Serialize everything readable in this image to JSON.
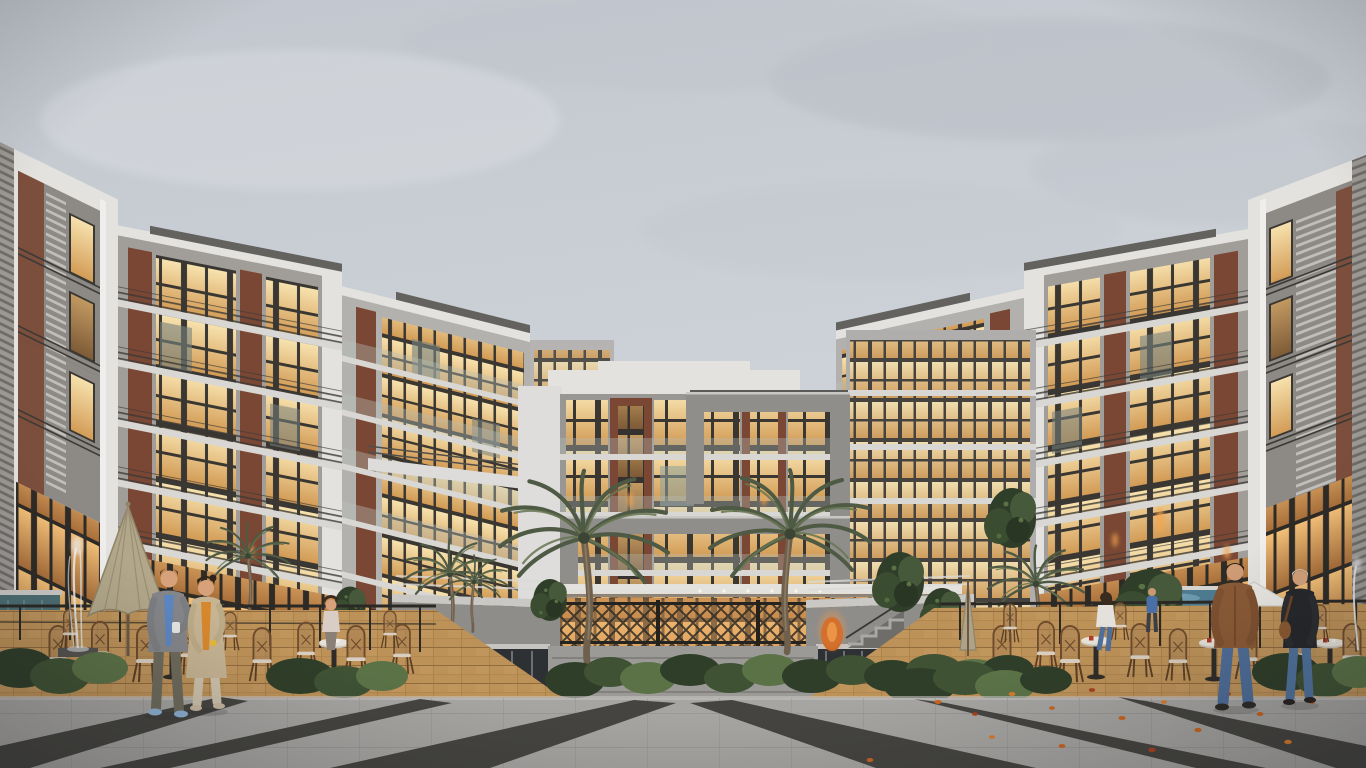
{
  "scene": {
    "type": "architectural-exterior-rendering",
    "description": "Dusk view of a modern U-shaped residential complex around a landscaped courtyard: gray concrete, white plaster and brick facades with warm glowing windows, two tall palm trees before the central block, cafe terraces with rattan bistro chairs and umbrellas on terracotta pavers, water features, and people strolling across a striped stone plaza with scattered autumn leaves.",
    "setting": {
      "sky": "overcast gray",
      "lighting": "warm interior glow at dusk",
      "ground": "light stone plaza with dark granite stripes"
    },
    "buildings": {
      "left_wing": {
        "floors": 5,
        "materials": [
          "white plaster",
          "gray concrete",
          "brick",
          "glass"
        ]
      },
      "central_block": {
        "floors": 5,
        "feature": "projecting gray frame over warm glass facade, brick piers"
      },
      "right_wing": {
        "floors": 5,
        "materials": [
          "white plaster",
          "gray concrete",
          "brick",
          "glass"
        ]
      }
    },
    "vegetation": [
      "large-palm-left",
      "large-palm-right",
      "small-palms",
      "evergreen-shrub-trees",
      "hedge-planters",
      "tropical-plant-left-terrace"
    ],
    "water_features": [
      "left-fountain-jet",
      "right-fountain-jet",
      "dark-reflecting-waterfall-walls",
      "right-blue-pool",
      "left-teal-pool"
    ],
    "cafes": {
      "left_terrace": {
        "umbrella": "tan",
        "chairs": "rattan bistro",
        "floor": "terracotta pavers"
      },
      "right_terrace": {
        "umbrella": "white",
        "chairs": "rattan bistro",
        "floor": "terracotta pavers"
      }
    },
    "people": [
      {
        "id": "walking-man-left",
        "clothing": [
          "gray blazer",
          "blue shirt",
          "olive trousers",
          "light-blue sneakers"
        ],
        "action": "walking with coffee cup"
      },
      {
        "id": "walking-woman-left",
        "clothing": [
          "long tan coat",
          "orange top",
          "beige trousers"
        ],
        "action": "walking beside man"
      },
      {
        "id": "seated-woman-left-cafe",
        "clothing": [
          "light top"
        ],
        "action": "sitting at cafe table"
      },
      {
        "id": "walking-man-right",
        "clothing": [
          "brown leather jacket",
          "blue jeans"
        ],
        "action": "walking away from viewer"
      },
      {
        "id": "walking-woman-right",
        "clothing": [
          "black jacket",
          "blue jeans",
          "brown shoulder bag"
        ],
        "action": "walking away from viewer"
      },
      {
        "id": "seated-woman-right-cafe",
        "clothing": [
          "white top",
          "blue jeans"
        ],
        "action": "sitting at cafe table"
      },
      {
        "id": "person-by-pool",
        "clothing": [
          "blue jacket"
        ],
        "action": "standing near right pool"
      }
    ],
    "details": [
      "autumn leaves on right plaza",
      "glowing amber urn",
      "dark lattice courtyard fence",
      "chrome planter railings",
      "white pedestrian bridges between blocks"
    ]
  },
  "palette": {
    "sky": "#cbd0d6",
    "cloud": "#b8bdc5",
    "white": "#e3e2df",
    "concrete": "#a19e9a",
    "concrete_dark": "#8e8c88",
    "concrete_light": "#b3b1ad",
    "brick": "#7a4734",
    "roof": "#63625f",
    "slab": "#d8d7d4",
    "glow": "#f0c583",
    "glow_deep": "#c08648",
    "glass_cool": "#7c8884",
    "foliage": "#2f3e29",
    "foliage_mid": "#3f5234",
    "foliage_light": "#5b7247",
    "trunk": "#6f604d",
    "terracotta": "#bd9258",
    "rattan": "#6d4b2c",
    "pave": "#a6a5a2",
    "stripe": "#454440",
    "curb": "#c4c2bf",
    "water_dark": "#2e3133",
    "pool": "#4e7b90",
    "pool_teal": "#4c6f74",
    "leaf": "#c9641f",
    "skin": "#d7a27b",
    "denim": "#4f6e99",
    "jacket_brown": "#8a5a36",
    "jacket_black": "#25272b",
    "coat_tan": "#c6b493",
    "top_orange": "#d8882c",
    "blazer_gray": "#85868a",
    "shirt_blue": "#5d86c2",
    "umbrella_tan": "#b2a78a",
    "chrome": "#dadad8"
  }
}
